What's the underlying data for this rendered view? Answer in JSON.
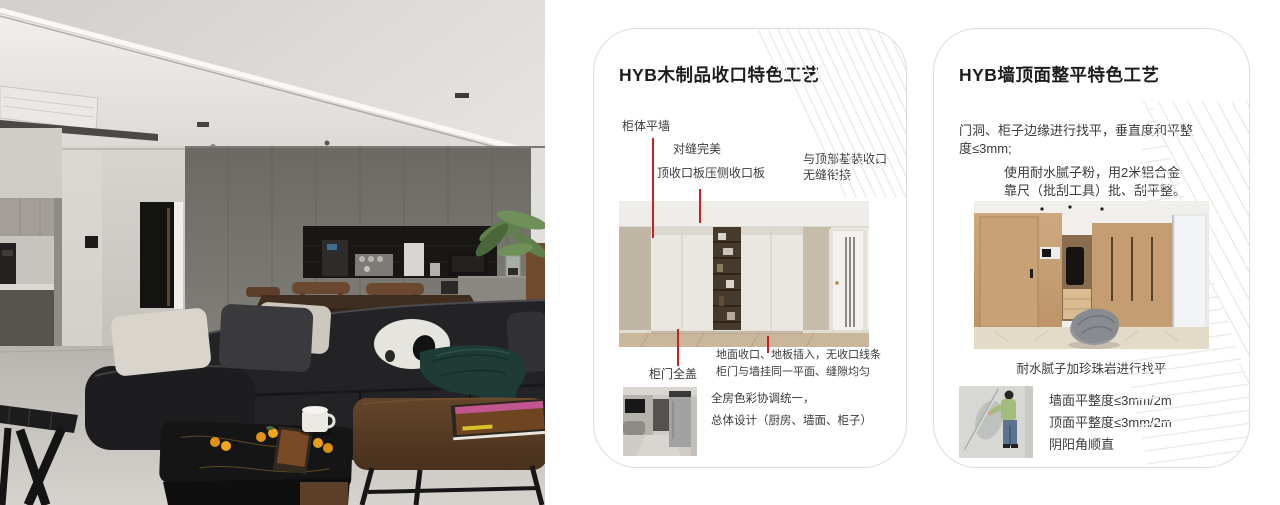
{
  "page": {
    "background": "#ffffff",
    "accent_red": "#cb201d",
    "card_border": "#dcdcdc"
  },
  "photo": {
    "description": "modern living room: grey cabinet wall with coffee niche, black leather sofa with panda cushion, walnut and black-marble coffee tables"
  },
  "card1": {
    "title": "HYB木制品收口特色工艺",
    "callout_cabinet_wall": "柜体平墙",
    "callout_seam": "对缝完美",
    "callout_top_panel": "顶收口板压侧收口板",
    "callout_ceiling_joint": "与顶部基装收口\n无缝衔接",
    "callout_full_door": "柜门全盖",
    "note_floor": "地面收口、地板插入，无收口线条\n柜门与墙挂同一平面、缝隙均匀",
    "summary": "全房色彩协调统一，\n总体设计（厨房、墙面、柜子）"
  },
  "card2": {
    "title": "HYB墙顶面整平特色工艺",
    "para_leveling": "门洞、柜子边缘进行找平，垂直度和平整\n度≤3mm;",
    "para_putty": "使用耐水腻子粉，用2米铝合金\n靠尺（批刮工具）批、刮平整。",
    "caption": "耐水腻子加珍珠岩进行找平",
    "specs": [
      "墙面平整度≤3mm/2m",
      "顶面平整度≤3mm/2m",
      "阴阳角顺直"
    ]
  }
}
